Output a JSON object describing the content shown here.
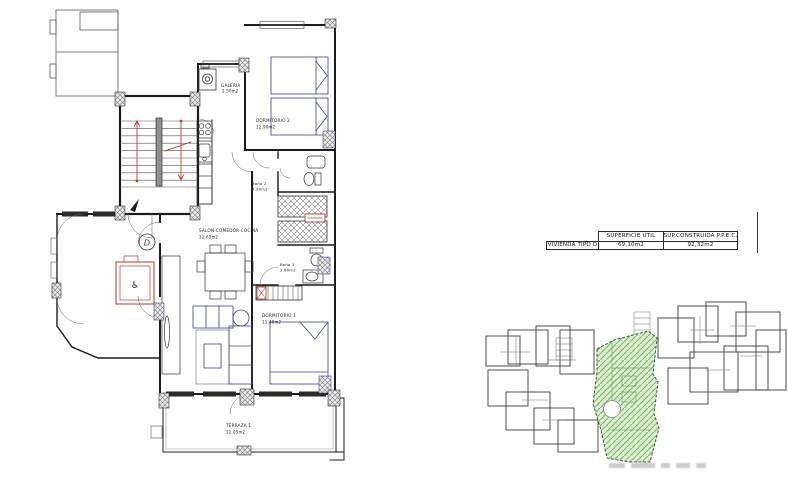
{
  "sheet": {
    "type": "apartment floor plan sheet"
  },
  "summary_table": {
    "headers": [
      "SUPERFICIE UTIL",
      "SUP.CONSTRUIDA P.P.E.C."
    ],
    "row": {
      "label": "VIVIENDA TIPO D",
      "util": "69,10m2",
      "construida": "92,32m2"
    }
  },
  "floorplan": {
    "unit_letter": "D",
    "rooms": [
      {
        "name": "GALERIA",
        "area": "2.50m2"
      },
      {
        "name": "DORMITORIO 2",
        "area": "12.90m2"
      },
      {
        "name": "Baño 2",
        "area": "3.90m2"
      },
      {
        "name": "SALON-COMEDOR-COCINA",
        "area": "32.65m2"
      },
      {
        "name": "Baño 1",
        "area": "3.60m2"
      },
      {
        "name": "DORMITORIO 1",
        "area": "11.40m2"
      },
      {
        "name": "TERRAZA 1",
        "area": "11.05m2"
      }
    ]
  },
  "icons": {
    "wheelchair": "♿"
  },
  "colors": {
    "wall": "#1c1c1c",
    "furniture_blue": "#3f3f93",
    "stair_red": "#c0392b",
    "accent_red": "#b03a30",
    "keyplan_outline": "#3a3a3a",
    "highlight_fill": "#ddeed3",
    "highlight_hatch": "#7cb667",
    "highlight_border": "#2f6d2f"
  }
}
